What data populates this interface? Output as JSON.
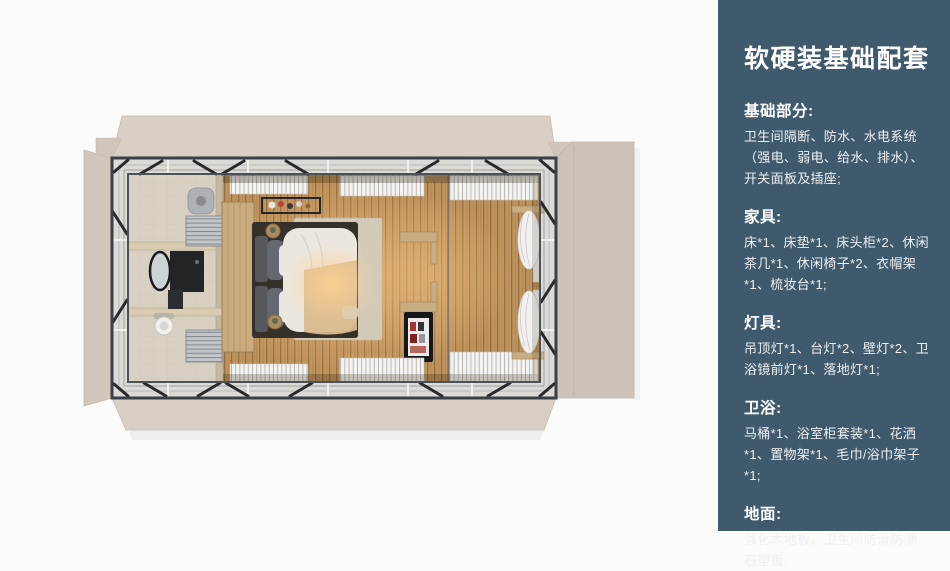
{
  "palette": {
    "page-bg": "#fbfbfa",
    "sidebar-bg": "#3f5a6d",
    "sidebar-text": "#eef1f2",
    "flap": "#d9cfc5",
    "flap-side": "#d1c6bb",
    "flap-right": "#cec3b8",
    "band": "#dbdad5",
    "frame": "#3a3f48",
    "wood-floor": "#bf935d",
    "glow": "#ffd193",
    "tile": "#d8d1c3",
    "wood-wall": "#c9ab7e",
    "duvet": "#ece7de",
    "blanket": "#d9ba8e",
    "curtain": "#f2f1ef"
  },
  "sidebar": {
    "title": "软硬装基础配套",
    "sections": [
      {
        "heading": "基础部分:",
        "body": "卫生间隔断、防水、水电系统（强电、弱电、给水、排水）、开关面板及插座;"
      },
      {
        "heading": "家具:",
        "body": "床*1、床垫*1、床头柜*2、休闲茶几*1、休闲椅子*2、衣帽架*1、梳妆台*1;"
      },
      {
        "heading": "灯具:",
        "body": "吊顶灯*1、台灯*2、壁灯*2、卫浴镜前灯*1、落地灯*1;"
      },
      {
        "heading": "卫浴:",
        "body": "马桶*1、浴室柜套装*1、花洒*1、置物架*1、毛巾/浴巾架子*1;"
      },
      {
        "heading": "地面:",
        "body": "强化木地板、卫生间防滑防潮石塑板;"
      }
    ]
  },
  "floorplan": {
    "view": "top-down-room-render",
    "elements": [
      "deck-flaps",
      "steel-frame",
      "wood-floor",
      "bathroom",
      "toilet",
      "vanity-mirror",
      "towel-radiator",
      "shower",
      "headboard-wall",
      "bed",
      "rug",
      "coat-rack",
      "side-stools",
      "wall-shelves",
      "display-cabinet",
      "window-blinds",
      "curtains",
      "glass-partition"
    ]
  }
}
